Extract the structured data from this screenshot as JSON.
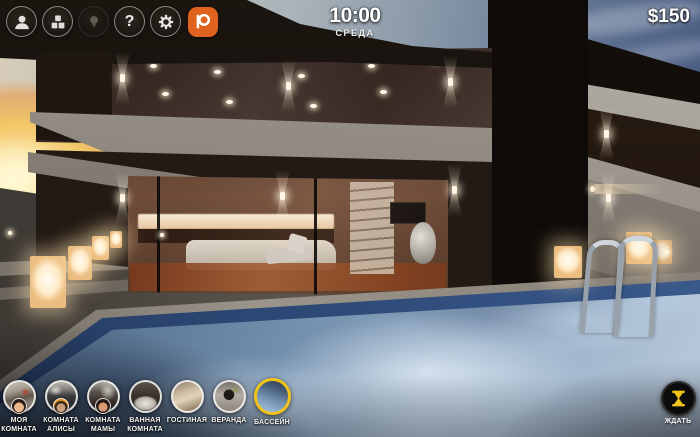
{
  "top_bar": {
    "time": "10:00",
    "day": "СРЕДА",
    "money": "$150",
    "icons": [
      {
        "name": "profile-icon"
      },
      {
        "name": "inventory-icon"
      },
      {
        "name": "hint-bulb-icon",
        "disabled": true
      },
      {
        "name": "help-icon",
        "glyph": "?"
      },
      {
        "name": "settings-gear-icon"
      },
      {
        "name": "patreon-icon"
      }
    ]
  },
  "rooms": {
    "items": [
      {
        "label": "МОЯ КОМНАТА",
        "active": false,
        "avatar": true
      },
      {
        "label": "КОМНАТА АЛИСЫ",
        "active": false,
        "avatar": true
      },
      {
        "label": "КОМНАТА МАМЫ",
        "active": false,
        "avatar": true
      },
      {
        "label": "ВАННАЯ КОМНАТА",
        "active": false,
        "avatar": false
      },
      {
        "label": "ГОСТИНАЯ",
        "active": false,
        "avatar": false
      },
      {
        "label": "ВЕРАНДА",
        "active": false,
        "avatar": false
      },
      {
        "label": "БАССЕЙН",
        "active": true,
        "avatar": false
      }
    ]
  },
  "wait_button": {
    "label": "ЖДАТЬ"
  },
  "scene": {
    "description": "modern villa at dusk with pool",
    "time_of_day": "evening"
  },
  "colors": {
    "accent_yellow": "#F2C21C",
    "patreon_orange": "#E0621F"
  }
}
